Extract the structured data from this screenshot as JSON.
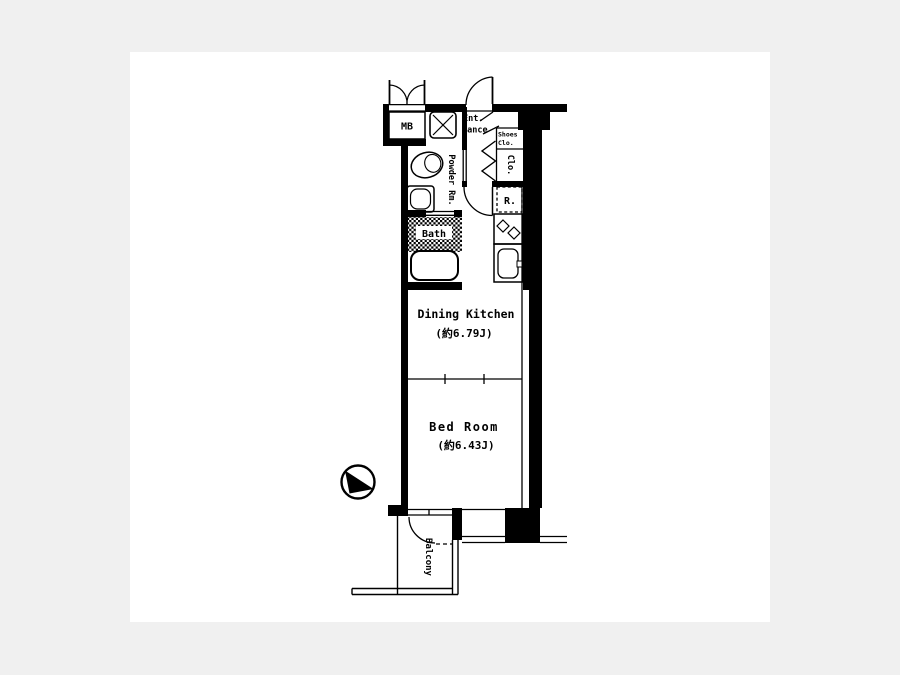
{
  "page": {
    "type": "apartment-floor-plan",
    "colors": {
      "background": "#f0f0f0",
      "canvas": "#ffffff",
      "ink": "#000000"
    }
  },
  "floor_plan": {
    "labels": {
      "mb": "MB",
      "entrance_line1": "Ent.",
      "entrance_line2": "rance",
      "shoes_closet_line1": "Shoes",
      "shoes_closet_line2": "Clo.",
      "closet": "Clo.",
      "refrigerator": "R.",
      "powder_room": "Powder Rm.",
      "bath": "Bath",
      "dining_kitchen_name": "Dining Kitchen",
      "dining_kitchen_size": "(約6.79J)",
      "bed_room_name": "Bed Room",
      "bed_room_size": "(約6.43J)",
      "balcony": "Balcony"
    },
    "fixtures": [
      "meter-box",
      "washing-machine-pan",
      "toilet",
      "wash-basin",
      "bathtub",
      "refrigerator-space",
      "stove",
      "kitchen-sink"
    ],
    "compass": {
      "direction": "north-west"
    }
  }
}
